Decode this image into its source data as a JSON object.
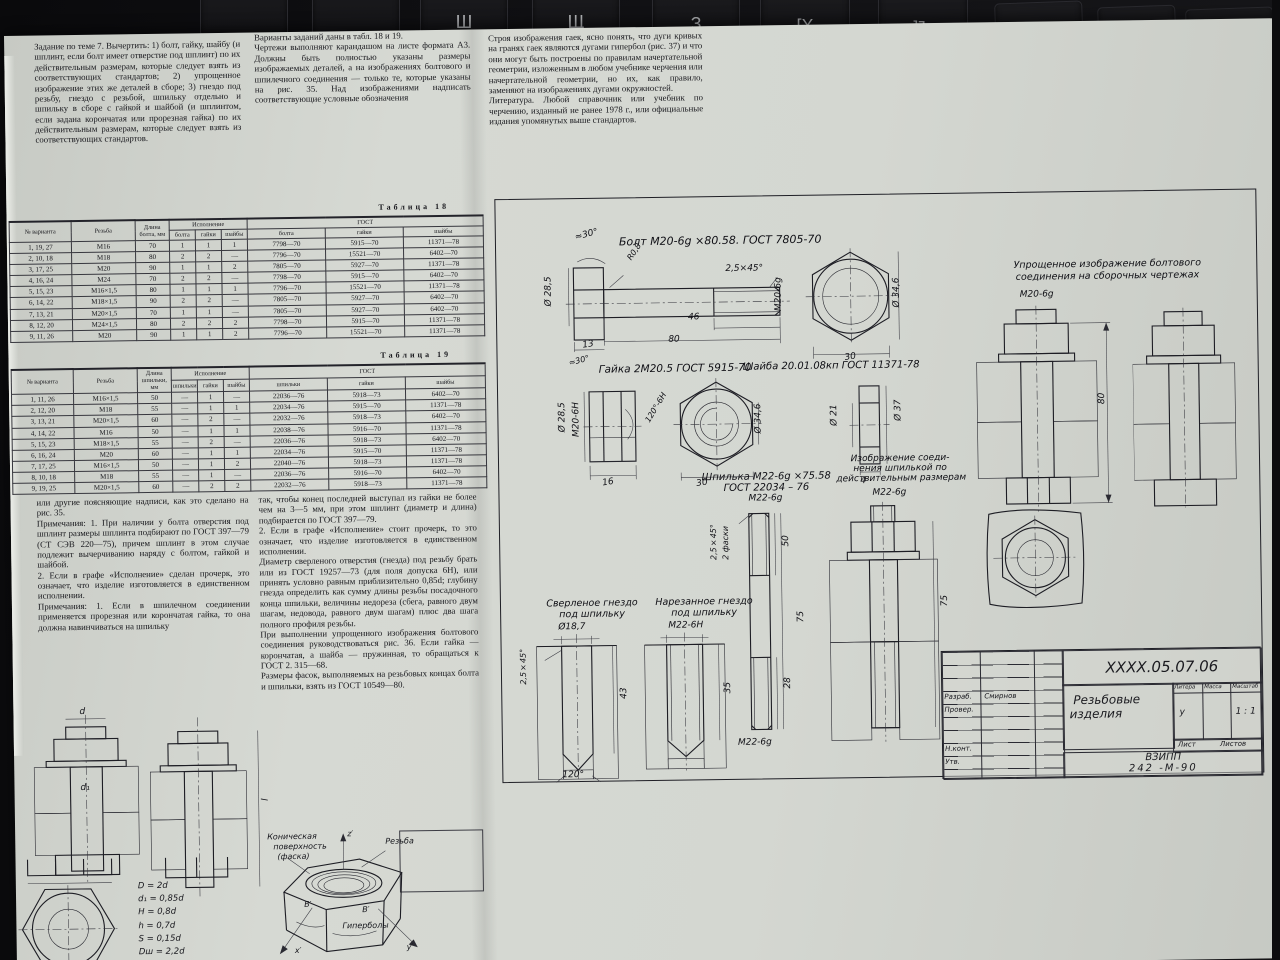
{
  "background": {
    "keys": [
      "Ш",
      "Щ",
      "З",
      "[Х",
      "]Ъ",
      "Delete",
      "End",
      "Page\nDown"
    ]
  },
  "page": {
    "columns": {
      "task": "Задание по теме 7. Вычертить: 1) болт, гайку, шайбу (и шплинт, если болт имеет отверстие под шплинт) по их действительным размерам, которые следует взять из соответствующих стандартов; 2) упрощенное изображение этих же деталей в сборе; 3) гнездо под резьбу, гнездо с резьбой, шпильку отдельно и шпильку в сборе с гайкой и шайбой (и шплинтом, если задана корончатая или прорезная гайка) по их действительным размерам, которые следует взять из соответствующих стандартов.",
      "variants": "Варианты заданий даны в табл. 18 и 19.\nЧертежи выполняют карандашом на листе формата А3. Должны быть полностью указаны размеры изображаемых деталей, а на изображениях болтового и шпилечного соединения — только те, которые указаны на рис. 35. Над изображениями надписать соответствующие условные обозначения",
      "hyperbolas": "Строя изображения гаек, ясно понять, что дуги кривых на гранях гаек являются дугами гипербол (рис. 37) и что они могут быть построены по правилам начертательной геометрии, изложенным в любом учебнике черчения или начертательной геометрии, но их, как правило, заменяют на изображениях дугами окружностей.\nЛитература. Любой справочник или учебник по черчению, изданный не ранее 1978 г., или официальные издания упомянутых выше стандартов.",
      "notes_left": "или другие поясняющие надписи, как это сделано на рис. 35.\nПримечания: 1. При наличии у болта отверстия под шплинт размеры шплинта подбирают по ГОСТ 397—79 (СТ СЭВ 220—75), причем шплинт в этом случае подлежит вычерчиванию наряду с болтом, гайкой и шайбой.\n2. Если в графе «Исполнение» сделан прочерк, это означает, что изделие изготовляется в единственном исполнении.\nПримечания: 1. Если в шпилечном соединении применяется прорезная или корончатая гайка, то она должна навинчиваться на шпильку",
      "notes_mid": "так, чтобы конец последней выступал из гайки не более чем на 3—5 мм, при этом шплинт (диаметр и длина) подбирается по ГОСТ 397—79.\n2. Если в графе «Исполнение» стоит прочерк, то это означает, что изделие изготовляется в единственном исполнении.\nДиаметр сверленого отверстия (гнезда) под резьбу брать или из ГОСТ 19257—73 (для поля допуска 6Н), или принять условно равным приблизительно 0,85d; глубину гнезда определить как сумму длины резьбы посадочного конца шпильки, величины недореза (сбега, равного двум шагам, недовода, равного двум шагам) плюс два шага полного профиля резьбы.\nПри выполнении упрощенного изображения болтового соединения руководствоваться рис. 36. Если гайка — корончатая, а шайба — пружинная, то обращаться к ГОСТ 2. 315—68.\nРазмеры фасок, выполняемых на резьбовых концах болта и шпильки, взять из ГОСТ 10549—80."
    },
    "table18": {
      "caption": "Таблица 18",
      "h_variant": "№ варианта",
      "h_thread": "Резьба",
      "h_length": "Длина болта, мм",
      "h_ispolnenie": "Исполнение",
      "h_gost": "ГОСТ",
      "h_bolta": "болта",
      "h_gaiki": "гайки",
      "h_shaiby": "шайбы",
      "h_gost_bolta": "болта",
      "h_gost_gaiki": "гайки",
      "h_gost_shaiby": "шайбы",
      "rows": [
        [
          "1, 19, 27",
          "М16",
          "70",
          "1",
          "1",
          "1",
          "7798—70",
          "5915—70",
          "11371—78"
        ],
        [
          "2, 10, 18",
          "М18",
          "80",
          "2",
          "2",
          "—",
          "7796—70",
          "15521—70",
          "6402—70"
        ],
        [
          "3, 17, 25",
          "М20",
          "90",
          "1",
          "1",
          "2",
          "7805—70",
          "5927—70",
          "11371—78"
        ],
        [
          "4, 16, 24",
          "М24",
          "70",
          "2",
          "2",
          "—",
          "7798—70",
          "5915—70",
          "6402—70"
        ],
        [
          "5, 15, 23",
          "М16×1,5",
          "80",
          "1",
          "1",
          "1",
          "7796—70",
          "15521—70",
          "11371—78"
        ],
        [
          "6, 14, 22",
          "М18×1,5",
          "90",
          "2",
          "2",
          "—",
          "7805—70",
          "5927—70",
          "6402—70"
        ],
        [
          "7, 13, 21",
          "М20×1,5",
          "70",
          "1",
          "1",
          "—",
          "7805—70",
          "5927—70",
          "6402—70"
        ],
        [
          "8, 12, 20",
          "М24×1,5",
          "80",
          "2",
          "2",
          "2",
          "7798—70",
          "5915—70",
          "11371—78"
        ],
        [
          "9, 11, 26",
          "М20",
          "90",
          "1",
          "1",
          "2",
          "7796—70",
          "15521—70",
          "11371—78"
        ]
      ]
    },
    "table19": {
      "caption": "Таблица 19",
      "h_variant": "№ варианта",
      "h_thread": "Резьба",
      "h_length": "Длина шпильки, мм",
      "h_ispolnenie": "Исполнение",
      "h_gost": "ГОСТ",
      "h_shpilki": "шпильки",
      "h_gaiki": "гайки",
      "h_shaiby": "шайбы",
      "h_gost_shpilki": "шпильки",
      "h_gost_gaiki": "гайки",
      "h_gost_shaiby": "шайбы",
      "rows": [
        [
          "1, 11, 26",
          "М16×1,5",
          "50",
          "—",
          "1",
          "—",
          "22036—76",
          "5918—73",
          "6402—70"
        ],
        [
          "2, 12, 20",
          "М18",
          "55",
          "—",
          "1",
          "1",
          "22034—76",
          "5915—70",
          "11371—78"
        ],
        [
          "3, 13, 21",
          "М20×1,5",
          "60",
          "—",
          "2",
          "—",
          "22032—76",
          "5918—73",
          "6402—70"
        ],
        [
          "4, 14, 22",
          "М16",
          "50",
          "—",
          "1",
          "1",
          "22038—76",
          "5916—70",
          "11371—78"
        ],
        [
          "5, 15, 23",
          "М18×1,5",
          "55",
          "—",
          "2",
          "—",
          "22036—76",
          "5918—73",
          "6402—70"
        ],
        [
          "6, 16, 24",
          "М20",
          "60",
          "—",
          "1",
          "1",
          "22034—76",
          "5915—70",
          "11371—78"
        ],
        [
          "7, 17, 25",
          "М16×1,5",
          "50",
          "—",
          "1",
          "2",
          "22040—76",
          "5918—73",
          "11371—78"
        ],
        [
          "8, 10, 18",
          "М18",
          "55",
          "—",
          "1",
          "—",
          "22036—76",
          "5916—70",
          "6402—70"
        ],
        [
          "9, 19, 25",
          "М20×1,5",
          "60",
          "—",
          "2",
          "2",
          "22032—76",
          "5918—73",
          "11371—78"
        ]
      ]
    },
    "figures": {
      "joint_dims": {
        "d": "d",
        "d1": "d₁",
        "l": "l"
      },
      "formulas": [
        "D = 2d",
        "d₁ = 0,85d",
        "H = 0,8d",
        "h = 0,7d",
        "S = 0,15d",
        "Dш = 2,2d"
      ],
      "nut3d": {
        "cone1": "Коническая",
        "cone2": "поверхность",
        "cone3": "(фаска)",
        "thread": "Резьба",
        "hyperbolas": "Гиперболы",
        "z": "z′",
        "x": "x′",
        "y": "y′",
        "b1": "B′",
        "b2": "В′"
      }
    }
  },
  "sheet": {
    "bolt": {
      "title": "Болт М20-6g ×80.58. ГОСТ 7805-70",
      "angle": "≈30°",
      "fillet": "R0,8",
      "d_head": "Ø 28,5",
      "chamfer": "2,5×45°",
      "thread": "М20-6g",
      "len_thread": "46",
      "len": "80",
      "head_h": "13",
      "d_circum": "Ø 34,6",
      "across": "30"
    },
    "nut": {
      "title": "Гайка 2М20.5 ГОСТ 5915-70",
      "angle": "≈30°",
      "d1": "Ø 28,5",
      "thread": "М20-6Н",
      "cone": "120°-6Н",
      "height": "16",
      "across": "30",
      "d_circum": "Ø 34,6"
    },
    "washer": {
      "title": "Шайба 20.01.08кп ГОСТ 11371-78",
      "d_in": "Ø 21",
      "d_out": "Ø 37",
      "thick": "4"
    },
    "simplified": {
      "title1": "Упрощенное изображение болтового",
      "title2": "соединения на сборочных чертежах",
      "thread": "М20-6g",
      "len": "80"
    },
    "stud": {
      "title1": "Шпилька М22-6g ×75.58",
      "title2": "ГОСТ 22034 – 76",
      "thread_top": "М22-6g",
      "chamfer": "2,5×45°",
      "chamfer2": "2 фаски",
      "l_top": "50",
      "l_full": "75",
      "l_bottom": "28",
      "thread_bottom": "М22-6g"
    },
    "stud_joint": {
      "title1": "Изображение соеди-",
      "title2": "нения шпилькой по",
      "title3": "действительным размерам",
      "thread": "М22-6g",
      "len": "75"
    },
    "drilled": {
      "title1": "Сверленое гнездо",
      "title2": "под шпильку",
      "dia": "Ø18,7",
      "chamfer": "2,5×45°",
      "depth": "43",
      "angle": "120°"
    },
    "tapped": {
      "title1": "Нарезанное гнездо",
      "title2": "под шпильку",
      "thread": "М22-6Н",
      "depth": "35"
    },
    "titleblock": {
      "designation": "ХХХХ.05.07.06",
      "name1": "Резьбовые",
      "name2": "изделия",
      "litera_label": "Литера",
      "massa_label": "Масса",
      "masshtab_label": "Масштаб",
      "litera": "у",
      "masshtab": "1 : 1",
      "list_label": "Лист",
      "listov_label": "Листов",
      "org1": "ВЗИПП",
      "org2": "242 -М-90",
      "razrab": "Разраб.",
      "razrab_name": "Смирнов",
      "prover": "Провер.",
      "nkont": "Н.конт.",
      "utv": "Утв."
    }
  }
}
